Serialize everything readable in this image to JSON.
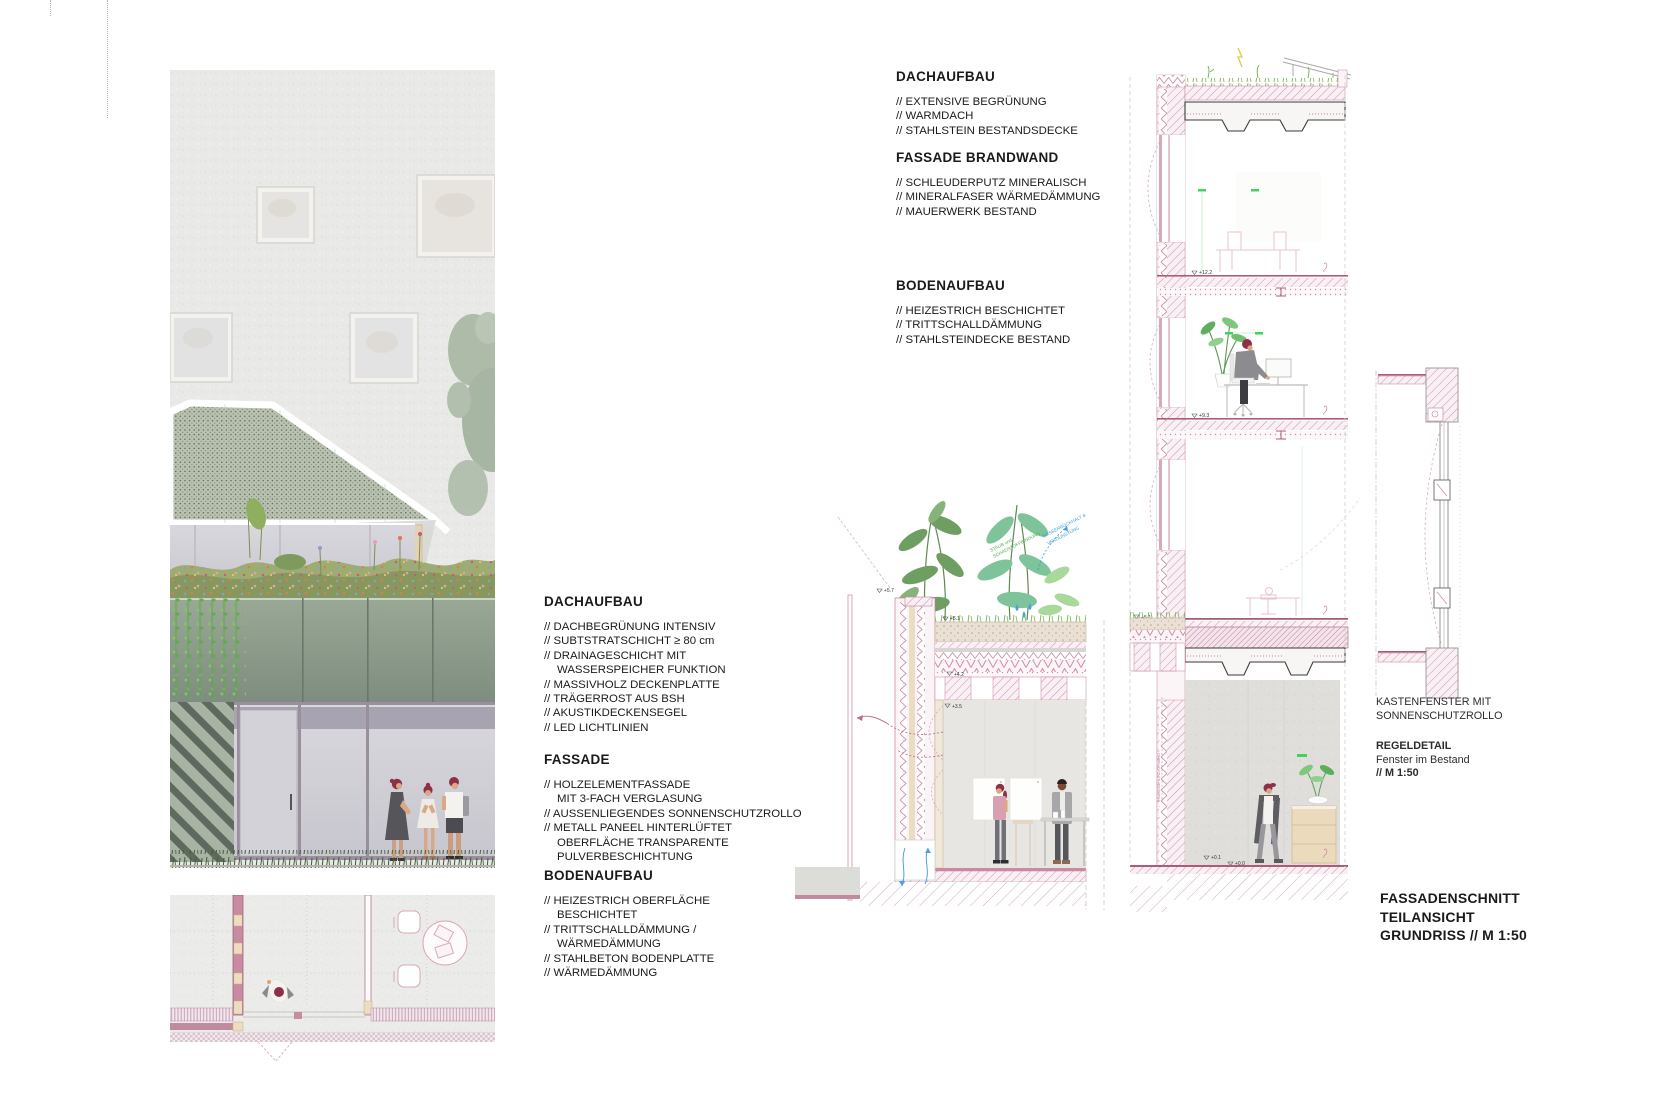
{
  "palette": {
    "line_pink": "#c87f9a",
    "accent_pink": "#b4607e",
    "accent_green": "#3fae49",
    "accent_blue": "#3f9fd8",
    "panel_green": "#7e8d7f",
    "text": "#1a1a1a"
  },
  "legend_middle": {
    "groups": [
      {
        "heading": "DACHAUFBAU",
        "lines": [
          "// DACHBEGRÜNUNG INTENSIV",
          "// SUBTSTRATSCHICHT ≥ 80 cm",
          "// DRAINAGESCHICHT MIT",
          "WASSERSPEICHER FUNKTION",
          "// MASSIVHOLZ DECKENPLATTE",
          "// TRÄGERROST AUS BSH",
          "// AKUSTIKDECKENSEGEL",
          "// LED LICHTLINIEN"
        ]
      },
      {
        "heading": "FASSADE",
        "lines": [
          "// HOLZELEMENTFASSADE",
          "MIT 3-FACH VERGLASUNG",
          "// AUSSENLIEGENDES SONNENSCHUTZROLLO",
          "// METALL PANEEL HINTERLÜFTET",
          "OBERFLÄCHE TRANSPARENTE",
          "PULVERBESCHICHTUNG"
        ]
      },
      {
        "heading": "BODENAUFBAU",
        "lines": [
          "// HEIZESTRICH OBERFLÄCHE",
          "BESCHICHTET",
          "// TRITTSCHALLDÄMMUNG /",
          "WÄRMEDÄMMUNG",
          "// STAHLBETON BODENPLATTE",
          "// WÄRMEDÄMMUNG"
        ]
      }
    ]
  },
  "legend_right": {
    "groups": [
      {
        "heading": "DACHAUFBAU",
        "items": [
          "// EXTENSIVE BEGRÜNUNG",
          "// WARMDACH",
          "// STAHLSTEIN BESTANDSDECKE"
        ]
      },
      {
        "heading": "FASSADE BRANDWAND",
        "items": [
          "// SCHLEUDERPUTZ MINERALISCH",
          "// MINERALFASER WÄRMEDÄMMUNG",
          "// MAUERWERK BESTAND"
        ]
      },
      {
        "heading": "BODENAUFBAU",
        "items": [
          "// HEIZESTRICH BESCHICHTET",
          "// TRITTSCHALLDÄMMUNG",
          "// STAHLSTEINDECKE BESTAND"
        ]
      }
    ]
  },
  "captions": {
    "kastenfenster_line1": "KASTENFENSTER MIT",
    "kastenfenster_line2": "SONNENSCHUTZROLLO",
    "regeldetail_title": "REGELDETAIL",
    "regeldetail_sub": "Fenster im Bestand",
    "regeldetail_scale": "// M 1:50"
  },
  "title": {
    "line1": "FASSADENSCHNITT",
    "line2": "TEILANSICHT",
    "line3": "GRUNDRISS // M 1:50"
  },
  "annotations": {
    "levels": {
      "l57": "+5.7",
      "l51a": "+5.1",
      "l42": "+4.2",
      "l35": "+3.5",
      "l122": "+12.2",
      "l93": "+9.3",
      "l51b": "+5.1",
      "l01": "+0.1",
      "l00": "+0.0"
    },
    "green1": "STAUB und",
    "green2": "SCHADSTOFFBINDUNG",
    "blue1": "WASSERRÜCKHALT &",
    "blue2": "VERDUNSTUNG",
    "brandschutz": "BRANDSCHUTZVORHANG",
    "rollgatter": "ROLLGATTER TGA"
  }
}
